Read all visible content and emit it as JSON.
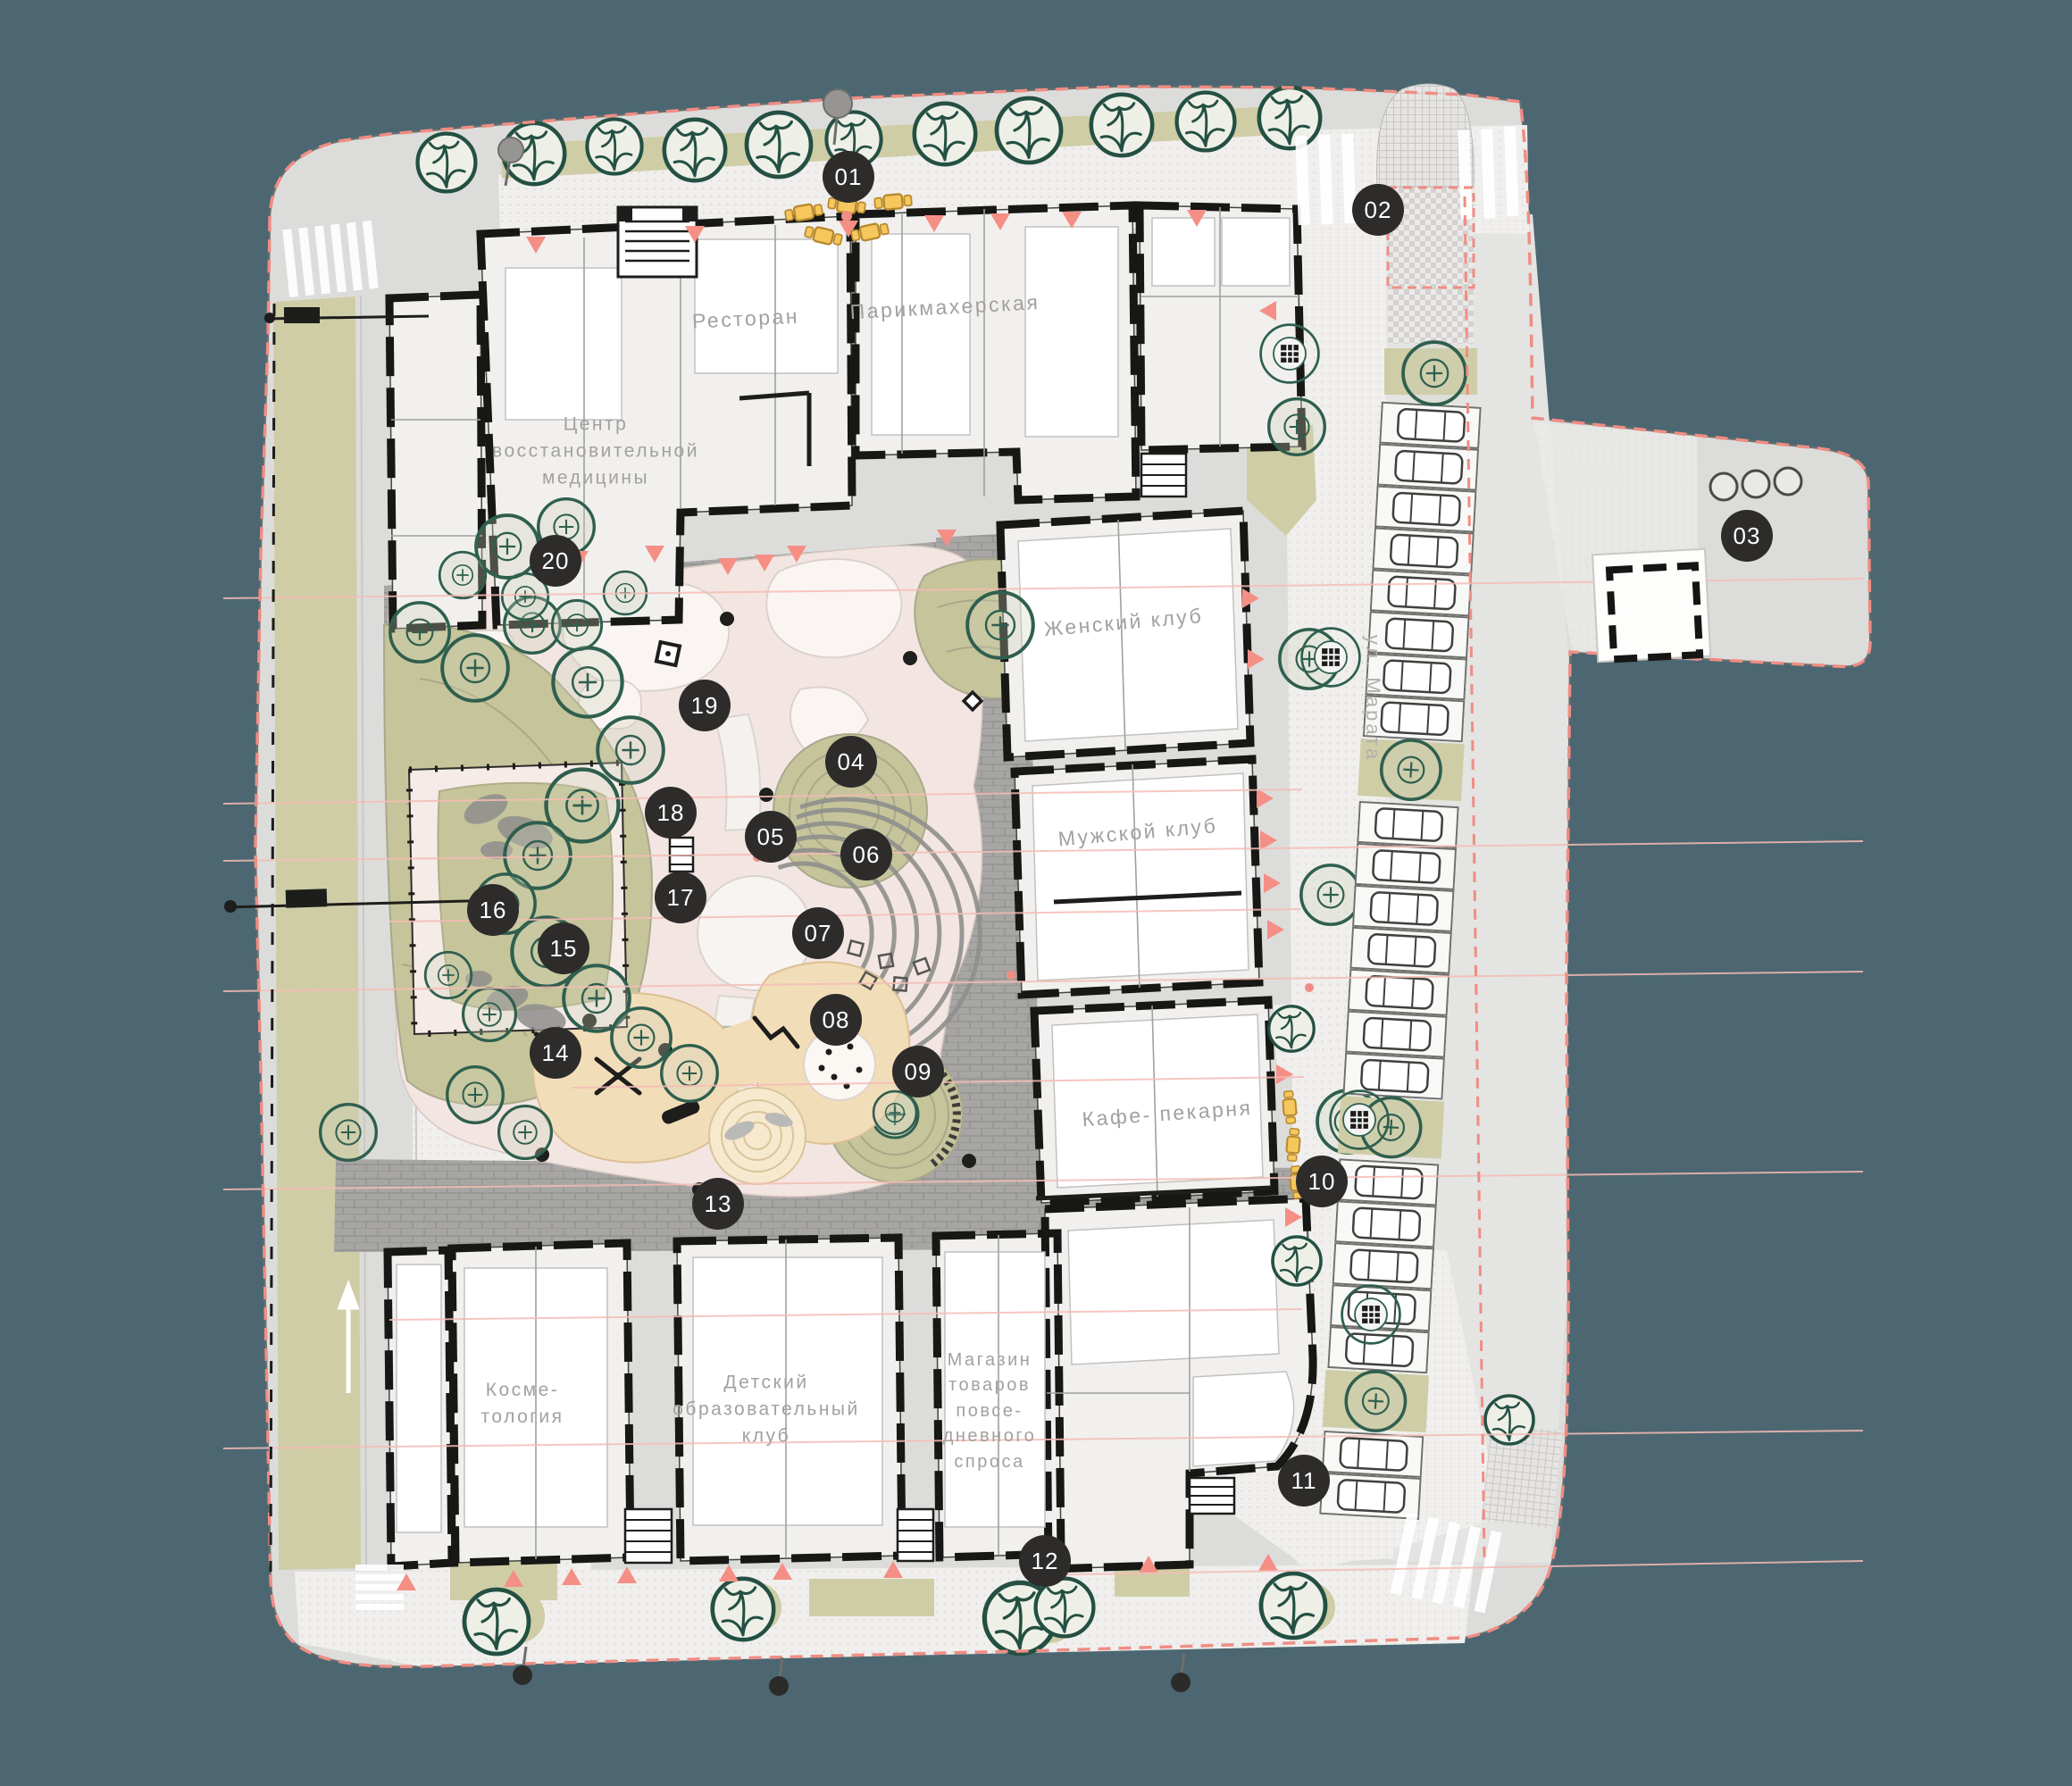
{
  "plan_title": "Landscape master plan of residential block",
  "street": {
    "name": "ул. Марата"
  },
  "buildings": {
    "restaurant": "Ресторан",
    "hairdresser": "Парикмахерская",
    "med_center": "Центр\nвосстановительной\nмедицины",
    "womens_club": "Женский клуб",
    "mens_club": "Мужской клуб",
    "cafe_bakery": "Кафе- пекарня",
    "cosmetology": "Косме-\nтология",
    "kids_club": "Детский\nобразовательный\nклуб",
    "convenience_store": "Магазин\nтоваров\nповсе-\nдневного\nспроса"
  },
  "markers": [
    {
      "label": "01"
    },
    {
      "label": "02"
    },
    {
      "label": "03"
    },
    {
      "label": "04"
    },
    {
      "label": "05"
    },
    {
      "label": "06"
    },
    {
      "label": "07"
    },
    {
      "label": "08"
    },
    {
      "label": "09"
    },
    {
      "label": "10"
    },
    {
      "label": "11"
    },
    {
      "label": "12"
    },
    {
      "label": "13"
    },
    {
      "label": "14"
    },
    {
      "label": "15"
    },
    {
      "label": "16"
    },
    {
      "label": "17"
    },
    {
      "label": "18"
    },
    {
      "label": "19"
    },
    {
      "label": "20"
    }
  ],
  "colors": {
    "background": "#4c6771",
    "land": "#dcdddb",
    "marker": "#2d2c2b",
    "boundary_red": "#ef8d84",
    "planting_khaki": "#cfcda6",
    "lawn_olive": "#c6c49a",
    "paving_gray": "#a7a6a4",
    "playground_beige": "#f2ddb9",
    "tree_green": "#2f5f4e",
    "furniture_yellow": "#f5c75c"
  }
}
